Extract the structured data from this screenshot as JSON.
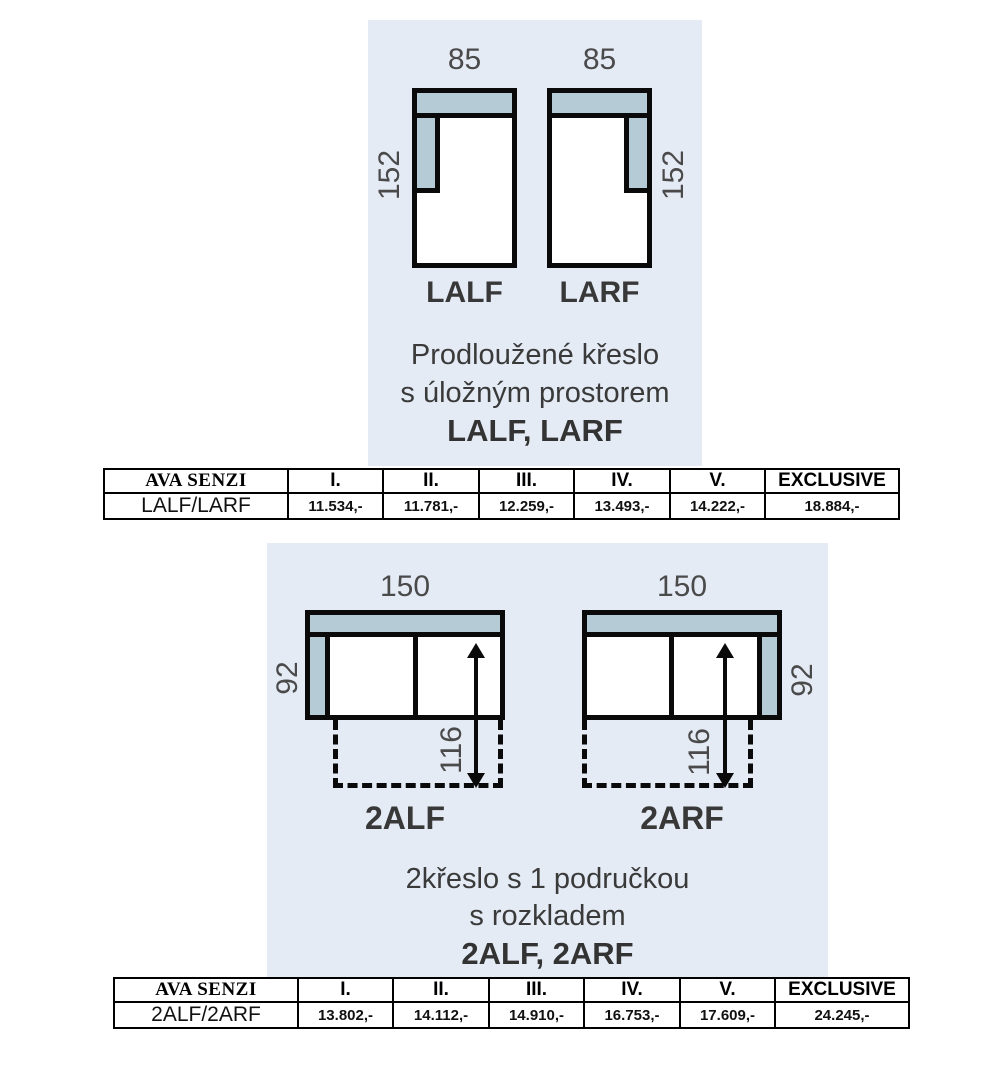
{
  "colors": {
    "panel_bg": "#e4ebf5",
    "cushion": "#b5cbd5",
    "outline": "#0a0a0a",
    "dim_text": "#4a4a4a"
  },
  "section1": {
    "diagrams": [
      {
        "name": "LALF",
        "width": "85",
        "height": "152",
        "arm_side": "left"
      },
      {
        "name": "LARF",
        "width": "85",
        "height": "152",
        "arm_side": "right"
      }
    ],
    "caption": {
      "line1": "Prodloužené křeslo",
      "line2": "s úložným prostorem",
      "line3": "LALF, LARF"
    },
    "table": {
      "headers": [
        "AVA SENZI",
        "I.",
        "II.",
        "III.",
        "IV.",
        "V.",
        "EXCLUSIVE"
      ],
      "row": [
        "LALF/LARF",
        "11.534,-",
        "11.781,-",
        "12.259,-",
        "13.493,-",
        "14.222,-",
        "18.884,-"
      ]
    }
  },
  "section2": {
    "diagrams": [
      {
        "name": "2ALF",
        "width": "150",
        "height": "92",
        "extension": "116",
        "arm_side": "left"
      },
      {
        "name": "2ARF",
        "width": "150",
        "height": "92",
        "extension": "116",
        "arm_side": "right"
      }
    ],
    "caption": {
      "line1": "2křeslo s 1 područkou",
      "line2": "s rozkladem",
      "line3": "2ALF, 2ARF"
    },
    "table": {
      "headers": [
        "AVA SENZI",
        "I.",
        "II.",
        "III.",
        "IV.",
        "V.",
        "EXCLUSIVE"
      ],
      "row": [
        "2ALF/2ARF",
        "13.802,-",
        "14.112,-",
        "14.910,-",
        "16.753,-",
        "17.609,-",
        "24.245,-"
      ]
    }
  }
}
